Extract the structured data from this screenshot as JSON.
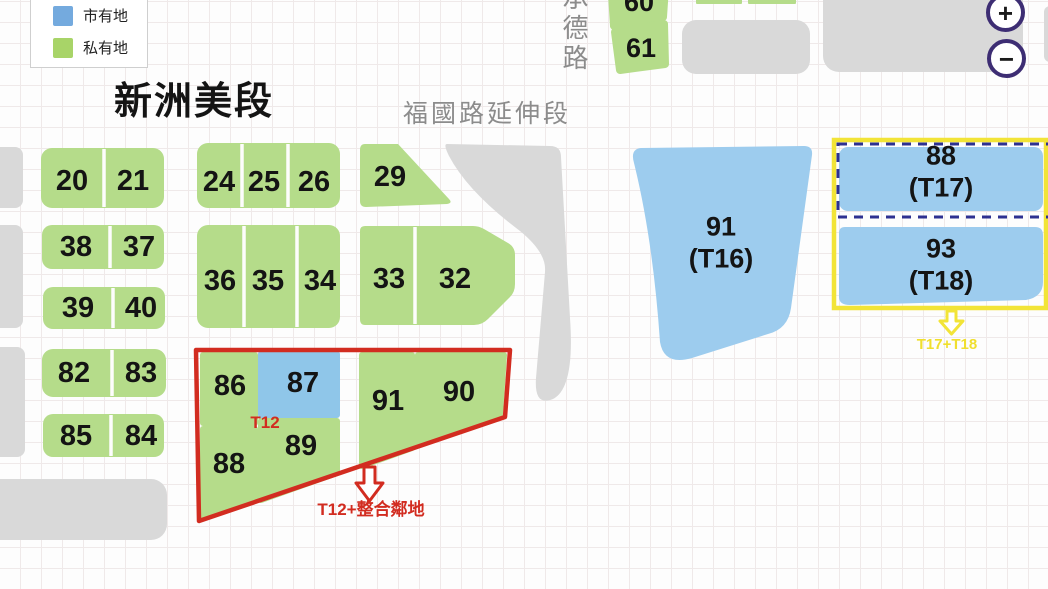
{
  "legend": {
    "items": [
      {
        "label": "市有地",
        "color": "#74aade"
      },
      {
        "label": "私有地",
        "color": "#a8d468"
      }
    ]
  },
  "title": "新洲美段",
  "roads": {
    "extension_label": "福國路延伸段",
    "vertical_label": "承德路"
  },
  "zoom_controls": {
    "zoom_in": "+",
    "zoom_out": "−"
  },
  "parcels": {
    "top": {
      "p60": "60",
      "p61": "61"
    },
    "left_rows": [
      [
        "20",
        "21"
      ],
      [
        "38",
        "37"
      ],
      [
        "39",
        "40"
      ],
      [
        "82",
        "83"
      ],
      [
        "85",
        "84"
      ]
    ],
    "mid_row1": [
      "24",
      "25",
      "26"
    ],
    "p29": "29",
    "mid_row2": [
      "36",
      "35",
      "34"
    ],
    "mid_row3": [
      "33",
      "32"
    ],
    "t12_group": {
      "tag": "T12",
      "arrow_label": "T12+整合鄰地",
      "p86": "86",
      "p87": "87",
      "p88": "88",
      "p89": "89",
      "p91": "91",
      "p90": "90"
    },
    "t16": {
      "num": "91",
      "code": "(T16)"
    },
    "t17": {
      "num": "88",
      "code": "(T17)"
    },
    "t18": {
      "num": "93",
      "code": "(T18)"
    },
    "t17t18_arrow_label": "T17+T18"
  },
  "colors": {
    "private_green": "#b5dc8a",
    "city_blue": "#8fc6e9",
    "light_city_blue": "#9dccee",
    "group_red": "#d22c20",
    "group_yellow": "#f2e437",
    "gray_block": "#d9d9d9",
    "navy_dash": "#2d3191",
    "zoom_ring_purple": "#3d2d73"
  }
}
